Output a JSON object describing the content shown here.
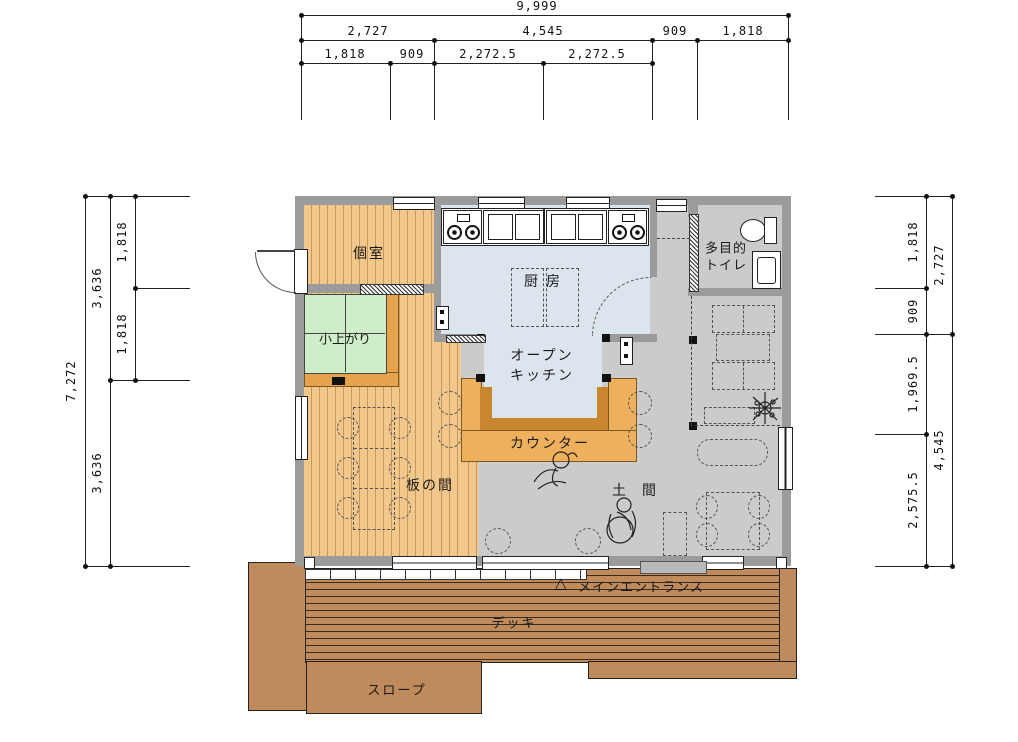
{
  "dims": {
    "top": {
      "total": "9,999",
      "row2": [
        "2,727",
        "4,545",
        "909",
        "1,818"
      ],
      "row3": [
        "1,818",
        "909",
        "2,272.5",
        "2,272.5"
      ]
    },
    "left": {
      "total": "7,272",
      "mid": [
        "3,636",
        "3,636"
      ],
      "inner": [
        "1,818",
        "1,818"
      ]
    },
    "right": {
      "inner": [
        "1,818",
        "909",
        "1,969.5",
        "2,575.5"
      ],
      "outer": [
        "2,727",
        "4,545"
      ]
    }
  },
  "rooms": {
    "koshitsu": "個室",
    "koagari": "小上がり",
    "kitchen": "厨 房",
    "open_kitchen": [
      "オープン",
      "キッチン"
    ],
    "counter": "カウンター",
    "itanoma": "板の間",
    "doma": "土 間",
    "toilet": [
      "多目的",
      "トイレ"
    ]
  },
  "site": {
    "entrance_marker": "△",
    "entrance": "メインエントランス",
    "deck": "デッキ",
    "slope": "スロープ"
  },
  "colors": {
    "wall": "#9b9b9b",
    "doma_floor": "#cbcbcb",
    "kitchen_floor": "#dce4ed",
    "wood_floor": "#f2c78c",
    "tatami": "#cdeec6",
    "tatami_frame": "#e6a34c",
    "counter_outer": "#eeb05c",
    "counter_inner": "#c8872f",
    "deck": "#bf8a5c"
  }
}
